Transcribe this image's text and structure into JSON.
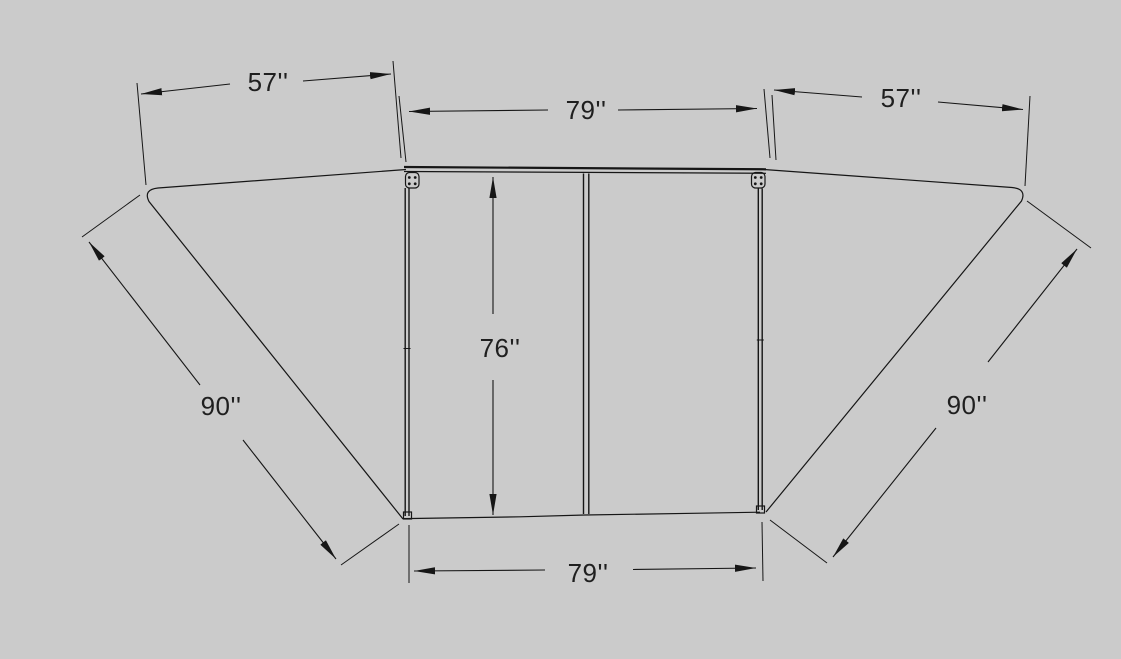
{
  "drawing": {
    "background_color": "#cbcbcb",
    "line_color": "#161616",
    "description": "Dimensioned technical drawing of a frame with two angled side wings",
    "dimensions": {
      "top_left": "57''",
      "top_center": "79''",
      "top_right": "57''",
      "center_vertical": "76''",
      "left_diagonal": "90''",
      "right_diagonal": "90''",
      "bottom_center": "79''"
    }
  }
}
